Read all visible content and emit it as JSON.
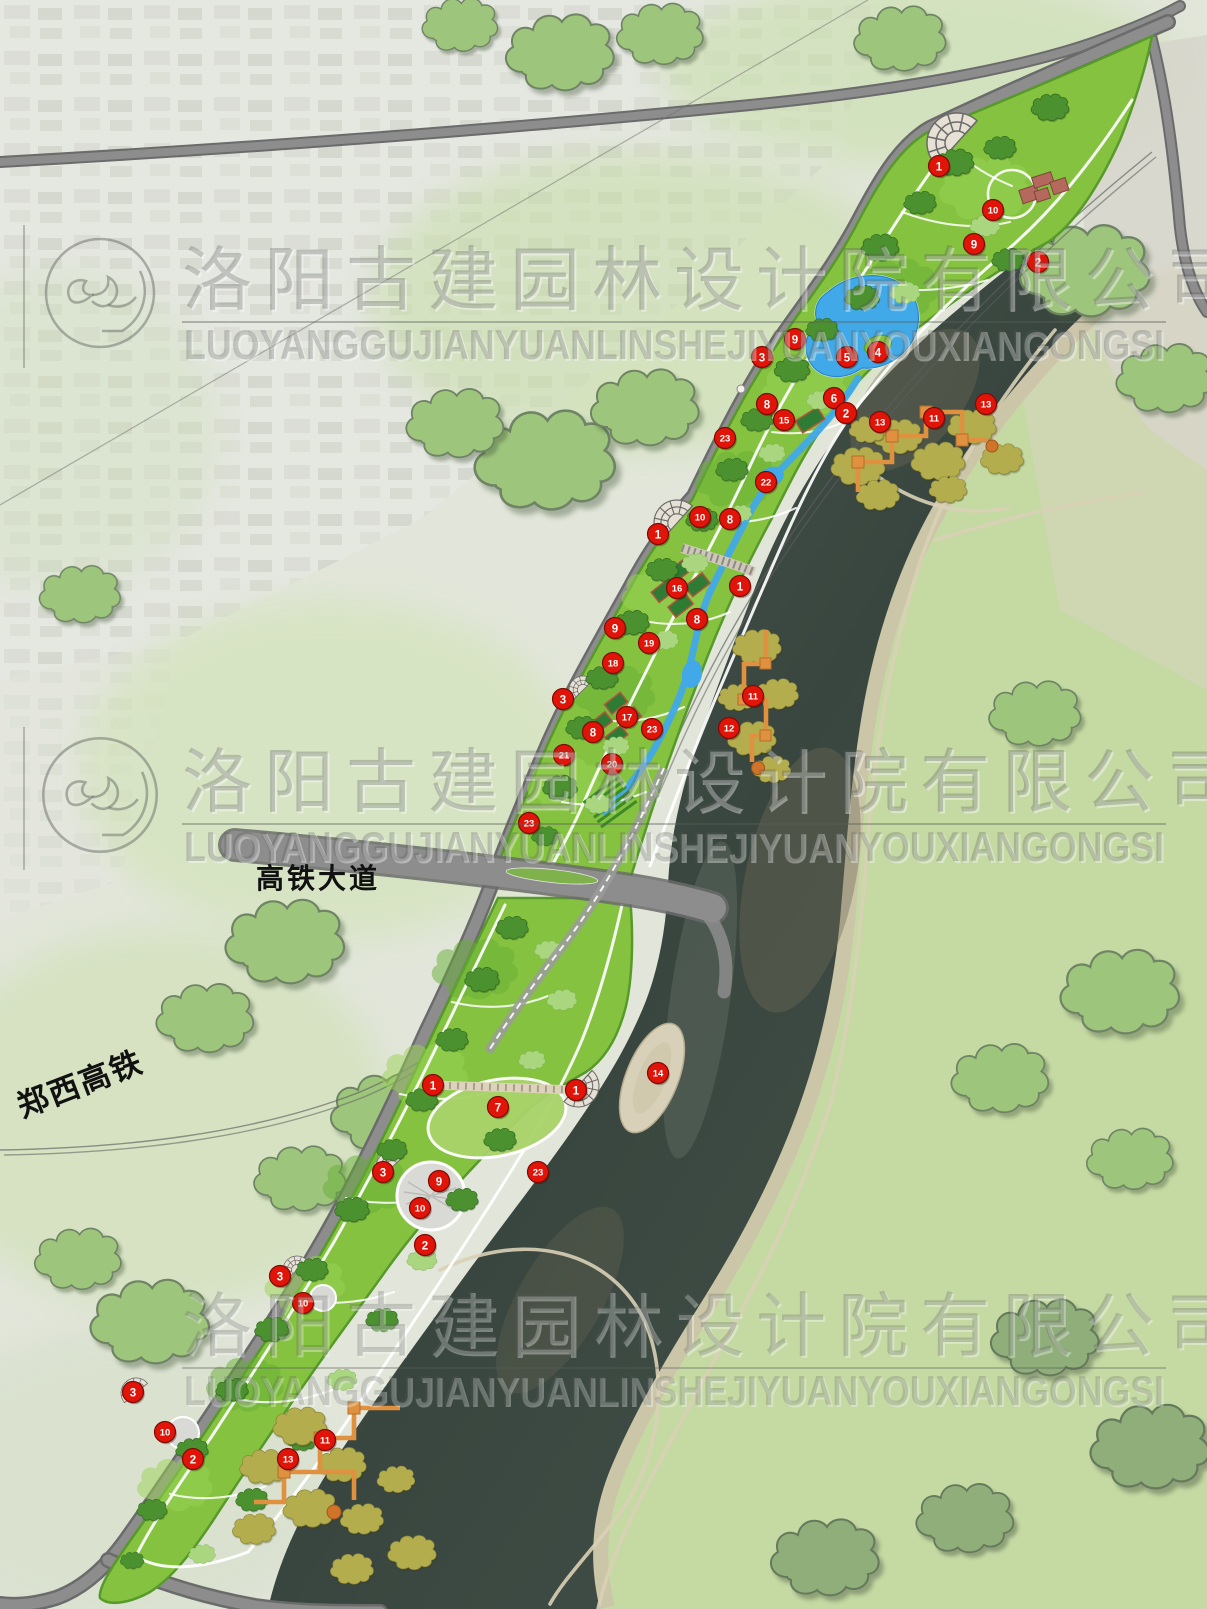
{
  "map": {
    "labels": {
      "road": "高铁大道",
      "railway": "郑西高铁"
    },
    "watermark": {
      "cn": "洛阳古建园林设计院有限公司",
      "latin": "LUOYANGGUJIANYUANLINSHEJIYUANYOUXIANGONGSI"
    },
    "colors": {
      "marker": "#e01408",
      "marker_border": "#7e0b04",
      "park_green": "#85c23f",
      "water": "#46544c",
      "lake": "#41a9e8",
      "boardwalk": "#e0913f",
      "road": "#8d8d8d"
    },
    "markers": [
      {
        "n": 1,
        "x": 939,
        "y": 166
      },
      {
        "n": 10,
        "x": 993,
        "y": 210
      },
      {
        "n": 9,
        "x": 974,
        "y": 244
      },
      {
        "n": 2,
        "x": 1038,
        "y": 262
      },
      {
        "n": 9,
        "x": 795,
        "y": 339
      },
      {
        "n": 3,
        "x": 762,
        "y": 357
      },
      {
        "n": 5,
        "x": 847,
        "y": 357
      },
      {
        "n": 4,
        "x": 878,
        "y": 352
      },
      {
        "n": 8,
        "x": 767,
        "y": 404
      },
      {
        "n": 6,
        "x": 834,
        "y": 398
      },
      {
        "n": 15,
        "x": 784,
        "y": 420
      },
      {
        "n": 2,
        "x": 846,
        "y": 413
      },
      {
        "n": 23,
        "x": 725,
        "y": 438
      },
      {
        "n": 13,
        "x": 880,
        "y": 422
      },
      {
        "n": 11,
        "x": 934,
        "y": 418
      },
      {
        "n": 13,
        "x": 986,
        "y": 404
      },
      {
        "n": 22,
        "x": 766,
        "y": 482
      },
      {
        "n": 1,
        "x": 658,
        "y": 534
      },
      {
        "n": 10,
        "x": 700,
        "y": 517
      },
      {
        "n": 8,
        "x": 730,
        "y": 519
      },
      {
        "n": 1,
        "x": 740,
        "y": 586
      },
      {
        "n": 16,
        "x": 677,
        "y": 588
      },
      {
        "n": 8,
        "x": 697,
        "y": 619
      },
      {
        "n": 9,
        "x": 615,
        "y": 628
      },
      {
        "n": 19,
        "x": 649,
        "y": 643
      },
      {
        "n": 18,
        "x": 613,
        "y": 663
      },
      {
        "n": 3,
        "x": 563,
        "y": 699
      },
      {
        "n": 17,
        "x": 627,
        "y": 717
      },
      {
        "n": 8,
        "x": 593,
        "y": 732
      },
      {
        "n": 23,
        "x": 652,
        "y": 729
      },
      {
        "n": 21,
        "x": 564,
        "y": 755
      },
      {
        "n": 20,
        "x": 612,
        "y": 764
      },
      {
        "n": 11,
        "x": 753,
        "y": 696
      },
      {
        "n": 12,
        "x": 729,
        "y": 728
      },
      {
        "n": 23,
        "x": 529,
        "y": 823
      },
      {
        "n": 1,
        "x": 433,
        "y": 1085
      },
      {
        "n": 1,
        "x": 576,
        "y": 1090
      },
      {
        "n": 7,
        "x": 498,
        "y": 1107
      },
      {
        "n": 14,
        "x": 658,
        "y": 1073
      },
      {
        "n": 3,
        "x": 383,
        "y": 1172
      },
      {
        "n": 9,
        "x": 439,
        "y": 1181
      },
      {
        "n": 10,
        "x": 420,
        "y": 1208
      },
      {
        "n": 23,
        "x": 538,
        "y": 1172
      },
      {
        "n": 2,
        "x": 425,
        "y": 1245
      },
      {
        "n": 3,
        "x": 280,
        "y": 1276
      },
      {
        "n": 10,
        "x": 303,
        "y": 1303
      },
      {
        "n": 3,
        "x": 133,
        "y": 1392
      },
      {
        "n": 10,
        "x": 165,
        "y": 1432
      },
      {
        "n": 2,
        "x": 193,
        "y": 1459
      },
      {
        "n": 11,
        "x": 325,
        "y": 1440
      },
      {
        "n": 13,
        "x": 288,
        "y": 1459
      }
    ]
  }
}
